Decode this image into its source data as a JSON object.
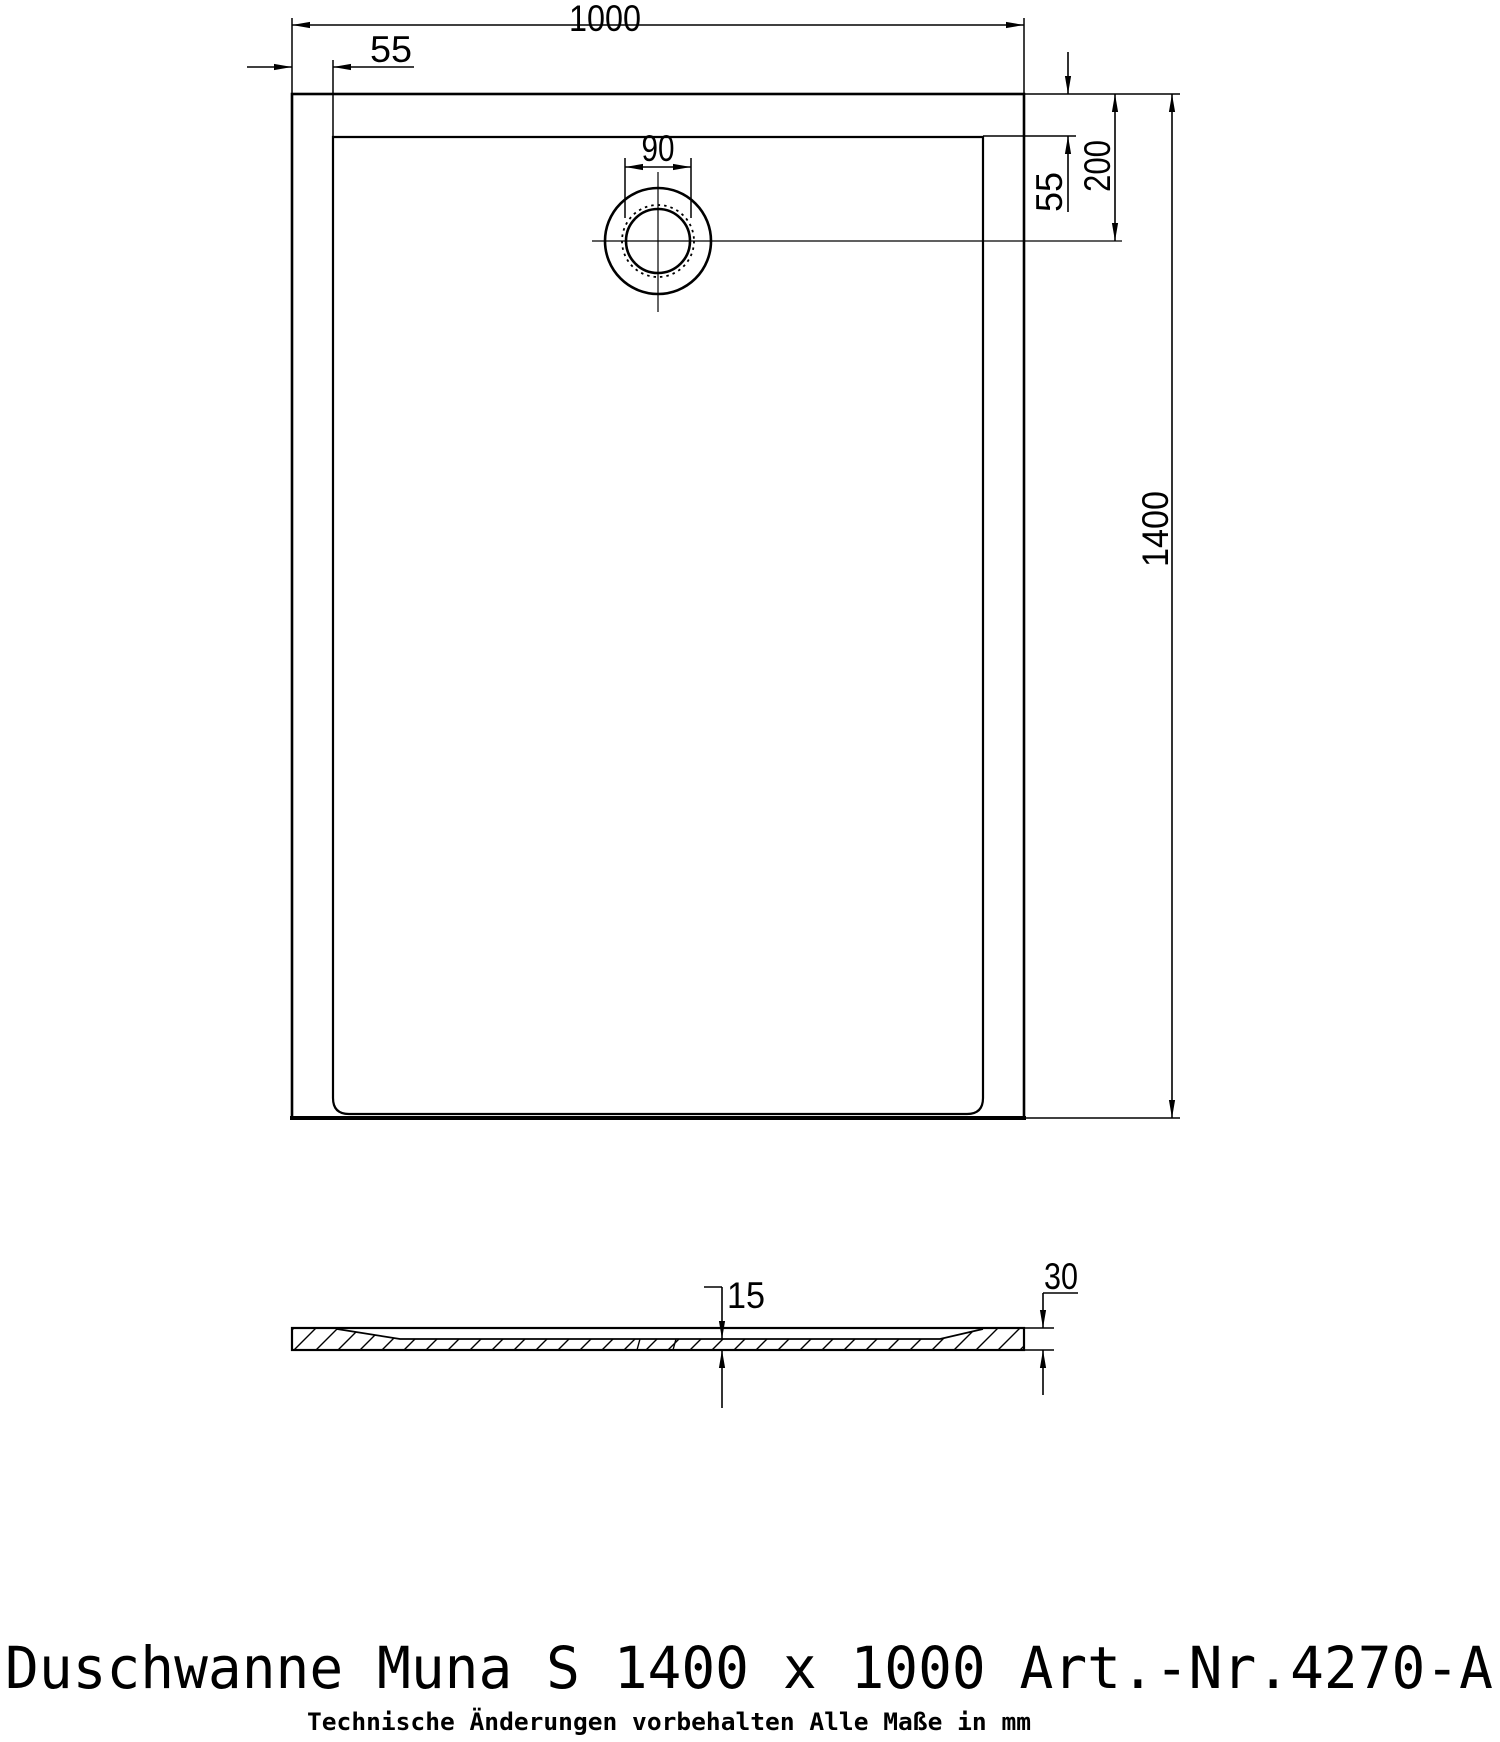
{
  "drawing": {
    "title": "Duschwanne Muna S 1400 x 1000 Art.-Nr.4270-A",
    "footnote": "Technische Änderungen vorbehalten   Alle Maße in mm",
    "line_color": "#000000",
    "background_color": "#ffffff",
    "views": {
      "plan": "top view shower tray with drain",
      "section": "side section profile with hatching"
    },
    "dims": {
      "overall_width": "1000",
      "rim_left": "55",
      "drain_diameter": "90",
      "rim_top_right": "55",
      "drain_center_from_top": "200",
      "overall_length": "1400",
      "floor_thickness_center": "15",
      "edge_height": "30"
    }
  }
}
